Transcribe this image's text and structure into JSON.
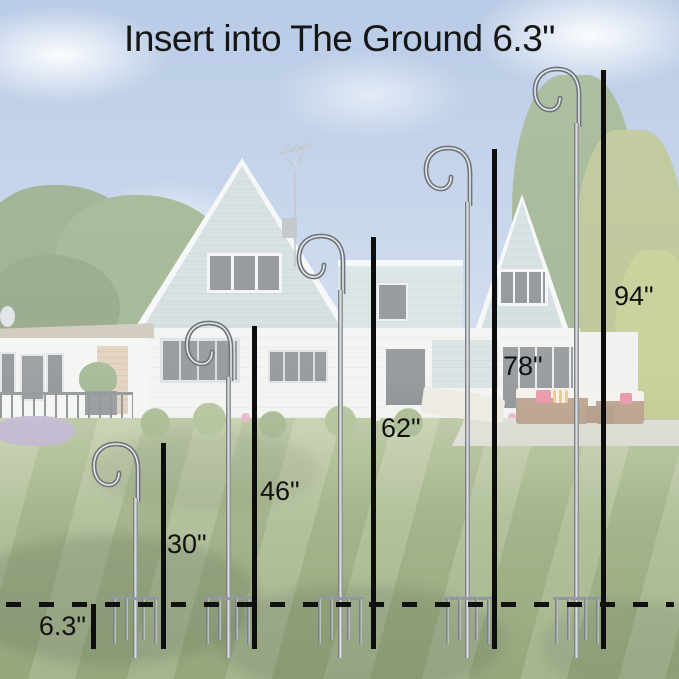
{
  "title": "Insert into The Ground 6.3\"",
  "diagram": {
    "depth_label": "6.3\"",
    "depth_inches": 6.3,
    "hooks": [
      {
        "label": "30\"",
        "height_inches": 30
      },
      {
        "label": "46\"",
        "height_inches": 46
      },
      {
        "label": "62\"",
        "height_inches": 62
      },
      {
        "label": "78\"",
        "height_inches": 78
      },
      {
        "label": "94\"",
        "height_inches": 94
      }
    ]
  },
  "colors": {
    "annotation_text": "#161616",
    "measure_line": "#0d0d0d",
    "pole_silver": "#b8bcc0",
    "sky": "#6e93cc",
    "lawn": "#7d9455",
    "house_siding": "#b2c4c8"
  }
}
